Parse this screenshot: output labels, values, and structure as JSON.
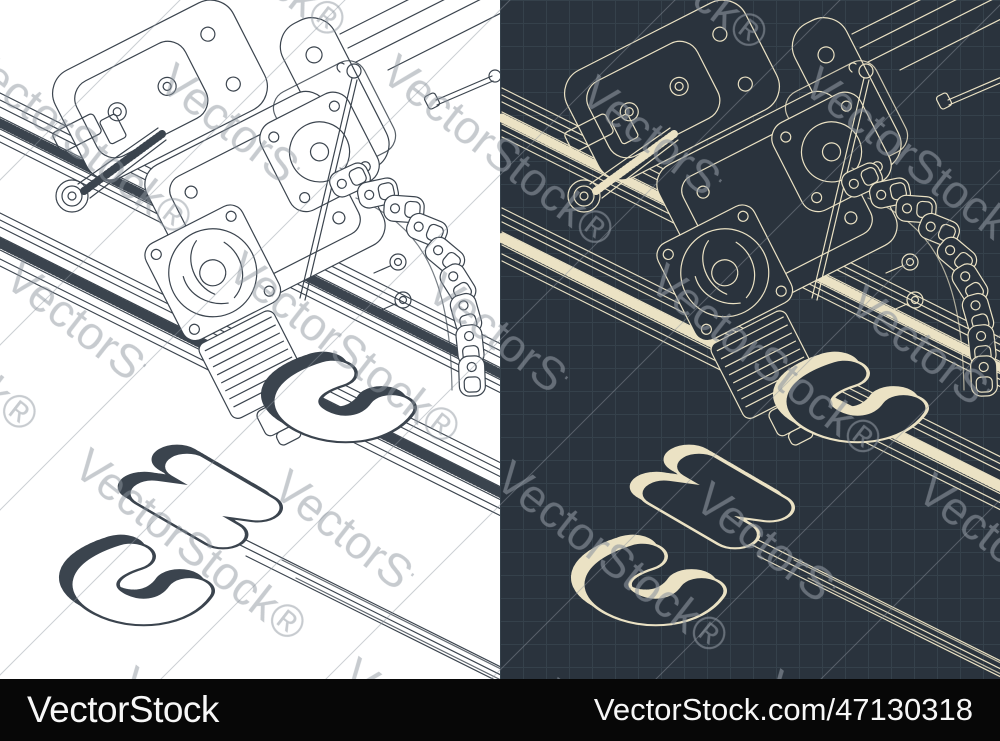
{
  "image": {
    "subject": "Isometric blueprints of a CNC laser machine",
    "engraved_text": "CNC"
  },
  "watermark": {
    "text": "VectorStock®"
  },
  "footer": {
    "brand": "VectorStock",
    "credit_url": "VectorStock.com/47130318"
  },
  "colors": {
    "left_bg": "#ffffff",
    "left_line": "#3b444e",
    "right_bg": "#2a333d",
    "right_line": "#ebe2c4",
    "grid_line": "#35414b",
    "watermark": "#8e969f",
    "bar_bg": "#070707",
    "bar_text": "#f7f7f7"
  }
}
